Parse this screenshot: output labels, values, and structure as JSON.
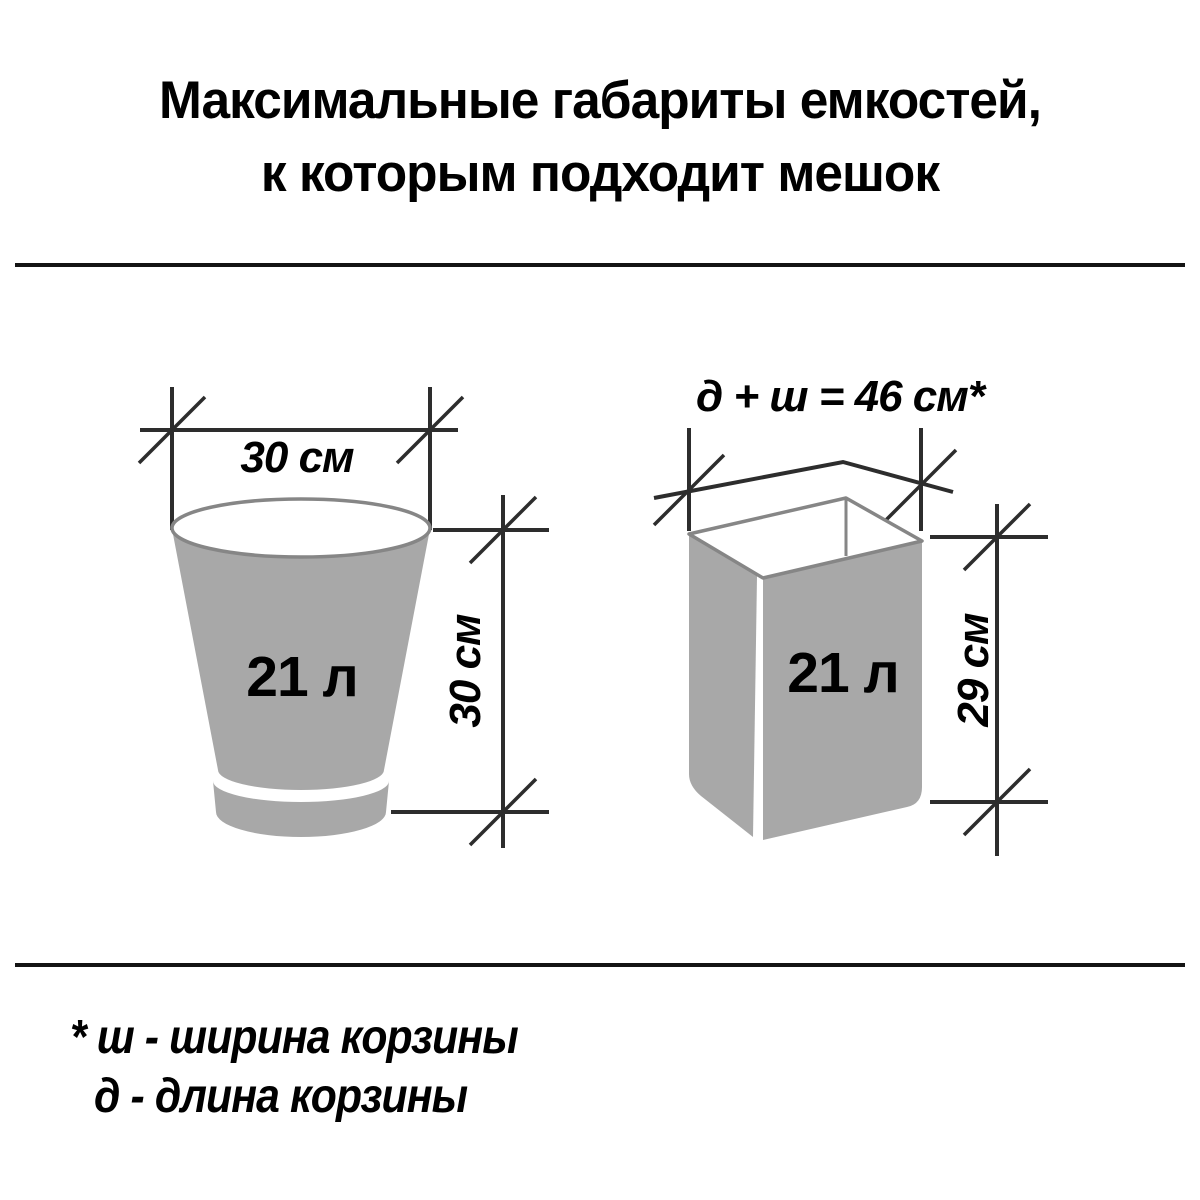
{
  "title": {
    "line1": "Максимальные габариты емкостей,",
    "line2": "к которым подходит мешок"
  },
  "left_figure": {
    "shape": "round bucket",
    "width_label": "30 см",
    "height_label": "30 см",
    "volume_label": "21 л"
  },
  "right_figure": {
    "shape": "rectangular basket",
    "formula_label": "д + ш = 46 см*",
    "height_label": "29 см",
    "volume_label": "21 л"
  },
  "footnote": {
    "line1": "* ш - ширина корзины",
    "line2": "д - длина корзины"
  },
  "colors": {
    "background": "#ffffff",
    "text": "#000000",
    "dimension_lines": "#2d2d2d",
    "container_fill": "#a8a8a8",
    "container_outline": "#868686"
  }
}
